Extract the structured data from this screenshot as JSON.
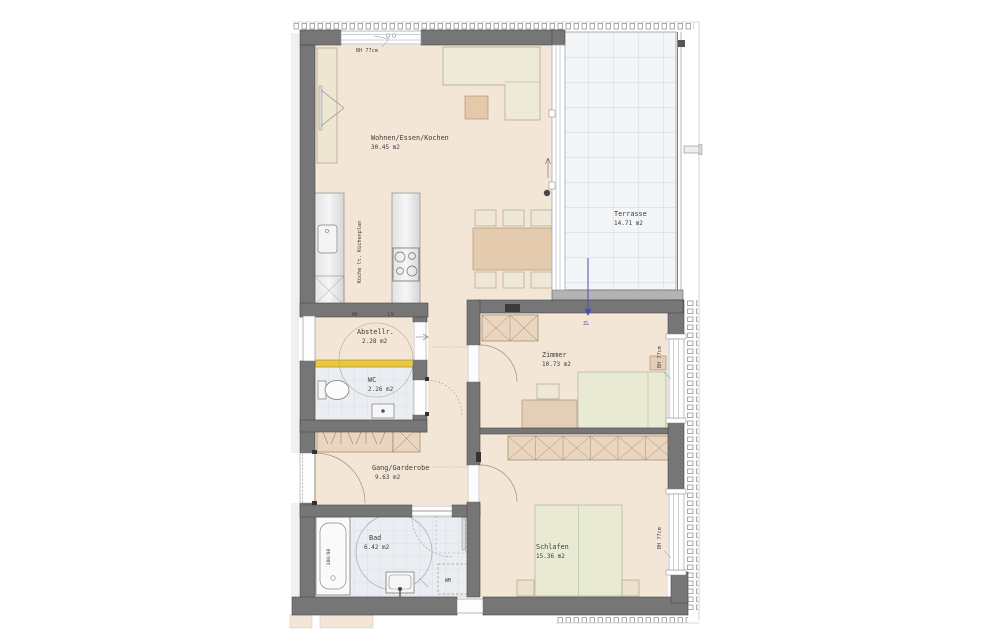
{
  "plan": {
    "rooms": {
      "wohnen": {
        "name": "Wohnen/Essen/Kochen",
        "area": "30.45 m2"
      },
      "terrasse": {
        "name": "Terrasse",
        "area": "14.71 m2"
      },
      "abstellraum": {
        "name": "Abstellr.",
        "area": "2.28 m2"
      },
      "wc": {
        "name": "WC",
        "area": "2.26 m2"
      },
      "zimmer": {
        "name": "Zimmer",
        "area": "10.73 m2"
      },
      "gang": {
        "name": "Gang/Garderobe",
        "area": "9.63 m2"
      },
      "bad": {
        "name": "Bad",
        "area": "6.42 m2"
      },
      "schlafen": {
        "name": "Schlafen",
        "area": "15.36 m2"
      }
    },
    "annotations": {
      "window_top": "BH 77cm",
      "window_zimmer": "BH 77cm",
      "window_schlafen": "BH 77cm",
      "kitchen_note": "Küche lt. Küchenplan",
      "bathtub_size": "180/80",
      "washing_machine": "WM",
      "hv": "HV",
      "lv": "LV",
      "supply_air": "ZL"
    },
    "colors": {
      "wall": "#767676",
      "floor": "#f4e6d7",
      "accent_yellow": "#e9c83f",
      "supply_air_blue": "#4a4ac8"
    }
  }
}
